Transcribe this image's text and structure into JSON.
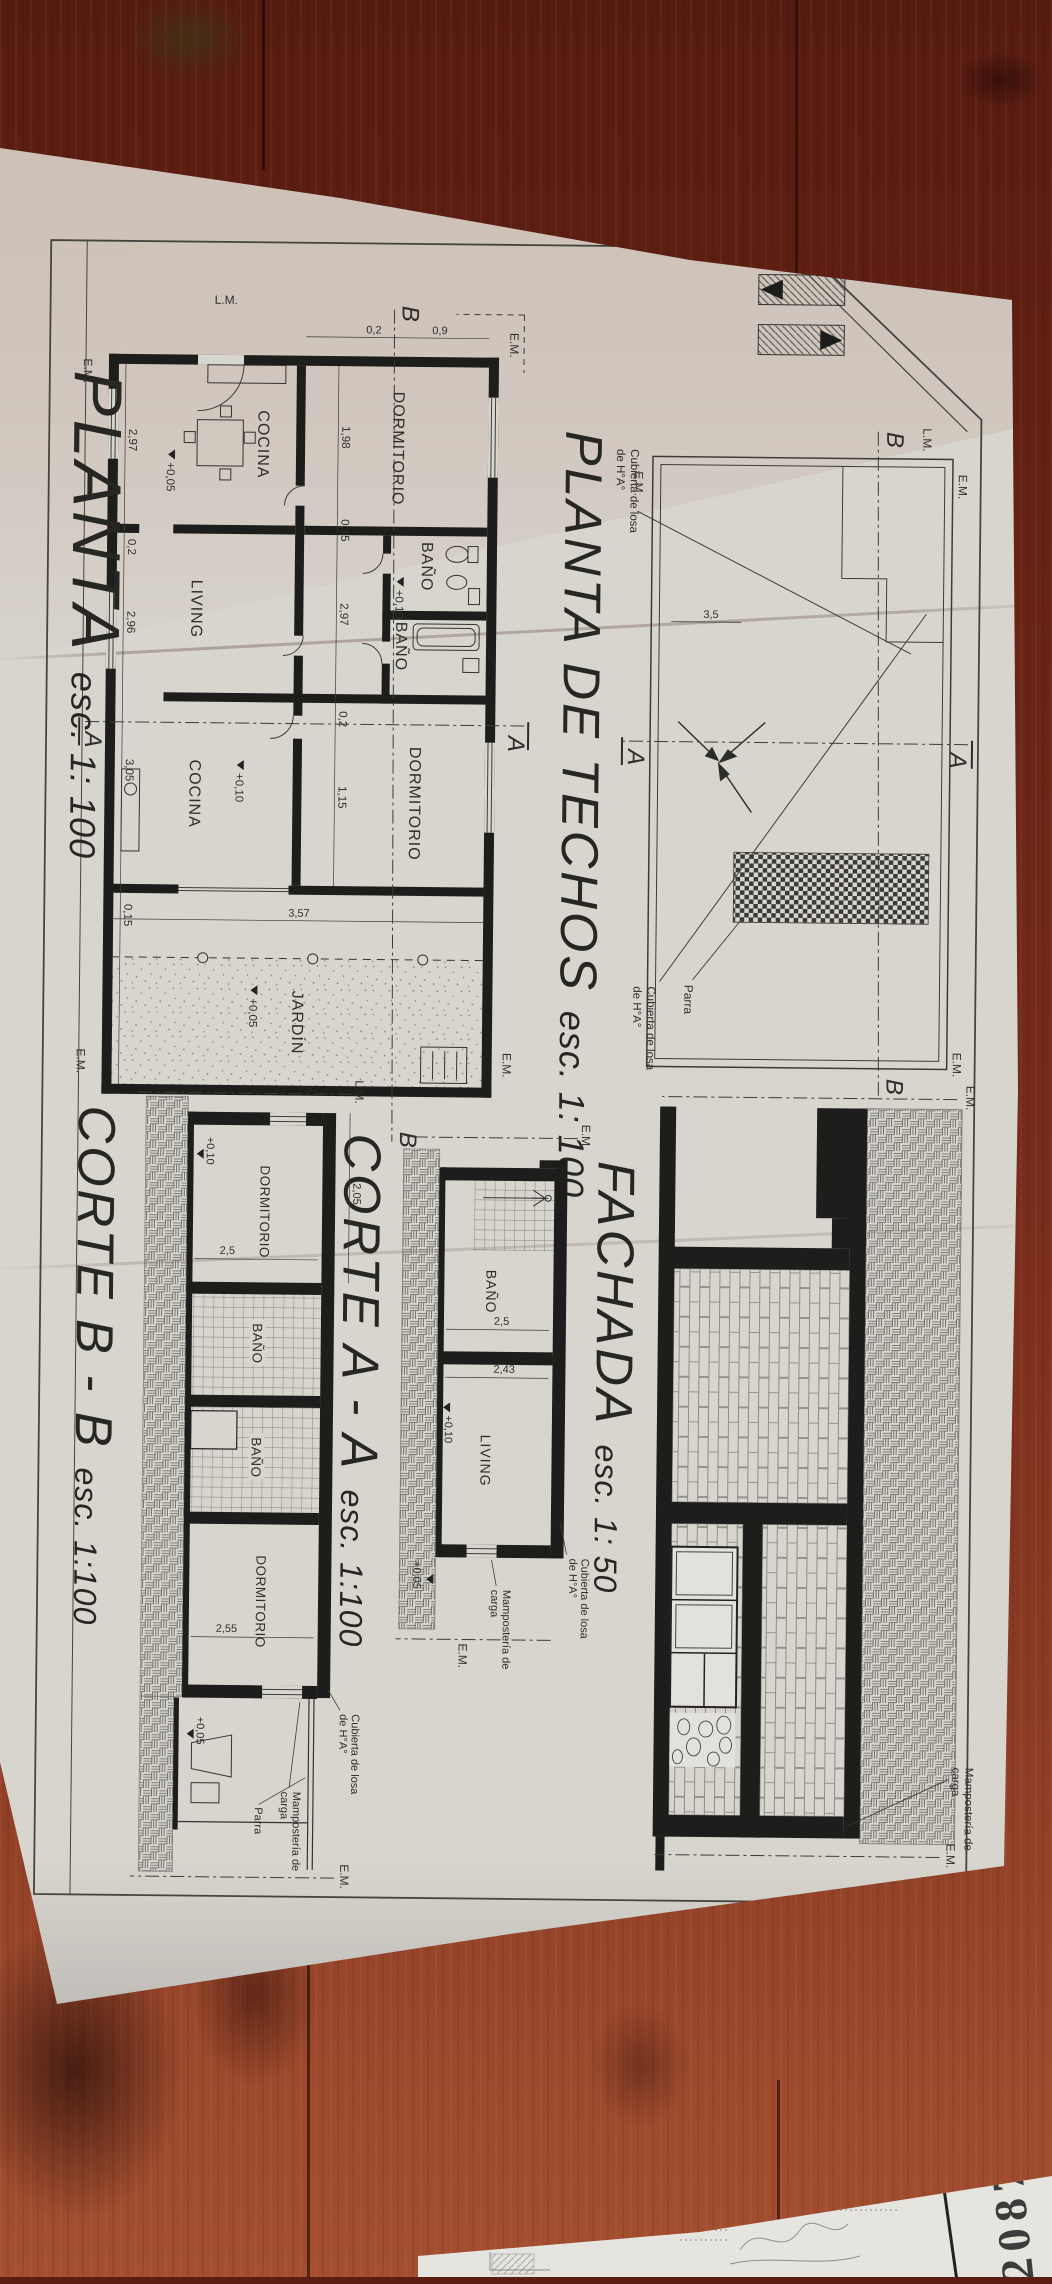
{
  "stamp": {
    "number": "2087"
  },
  "titles": {
    "planta": "PLANTA",
    "planta_esc": "esc. 1: 100",
    "techos": "PLANTA DE TECHOS",
    "techos_esc": "esc. 1: 100",
    "fachada": "FACHADA",
    "fachada_esc": "esc. 1: 50",
    "corte_a": "CORTE A - A",
    "corte_a_esc": "esc. 1:100",
    "corte_b": "CORTE B - B",
    "corte_b_esc": "esc. 1:100"
  },
  "markers": {
    "em": "E.M.",
    "lm": "L.M.",
    "sec_a": "A",
    "sec_b": "B"
  },
  "annotations": {
    "cubierta_l1": "Cubierta de losa",
    "cubierta_l2": "de H°A°",
    "mamposteria_l1": "Mampostería de",
    "mamposteria_l2": "carga",
    "parra": "Parra"
  },
  "levels": {
    "p10": "+0,10",
    "p05": "+0,05"
  },
  "floor_plan": {
    "rooms": {
      "dorm1": "DORMITORIO",
      "bano1": "BAÑO",
      "bano2": "BAÑO",
      "dorm2": "DORMITORIO",
      "cocina1": "COCINA",
      "living": "LIVING",
      "cocina2": "COCINA",
      "jardin": "JARDÍN"
    },
    "dims_upper": [
      "1,98",
      "0,15",
      "2,97",
      "0,2",
      "1,15"
    ],
    "dims_lower": [
      "2,97",
      "0,2",
      "2,96",
      "3,05",
      "0,15"
    ],
    "dims_left": [
      "0,9",
      "0,2"
    ],
    "dim_jardin": "3,57"
  },
  "roof_plan": {
    "dim": "3,5"
  },
  "corte_a": {
    "room1": "BAÑO",
    "room2": "LIVING",
    "dim1": "2,5",
    "dim2": "2,43"
  },
  "corte_b": {
    "room1": "DORMITORIO",
    "room2": "BAÑO",
    "room3": "BAÑO",
    "room4": "DORMITORIO",
    "dim_window": "2,05",
    "dim1": "2,5",
    "dim2": "2,55"
  }
}
